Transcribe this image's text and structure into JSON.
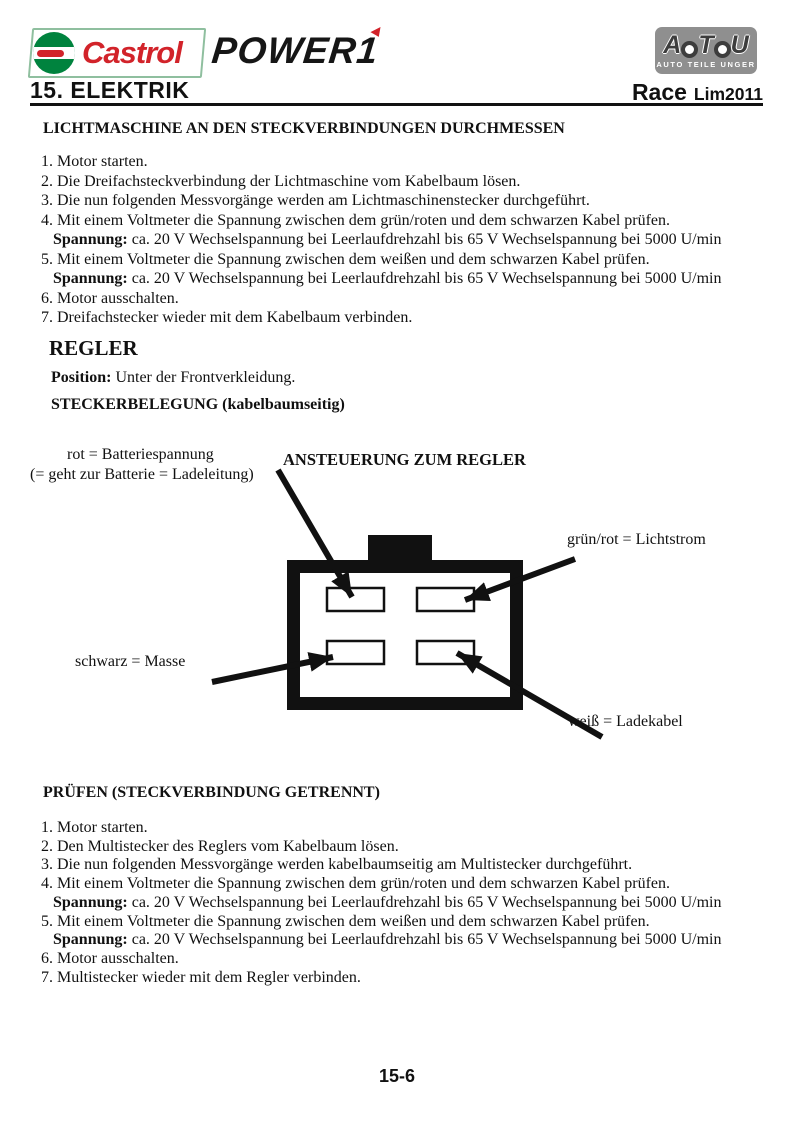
{
  "colors": {
    "castrol_red": "#d2232a",
    "castrol_green": "#00833e",
    "atu_gray": "#8f8f8f",
    "ink": "#111111"
  },
  "header": {
    "castrol_brand": "Castrol",
    "product_logo": "POWER1",
    "atu_letters": [
      "A",
      "T",
      "U"
    ],
    "atu_caption": "AUTO TEILE UNGER",
    "chapter": "15. ELEKTRIK",
    "model": "Race",
    "model_variant": "Lim2011"
  },
  "section1": {
    "title": "LICHTMASCHINE AN DEN STECKVERBINDUNGEN DURCHMESSEN",
    "lines": [
      {
        "text": "1. Motor starten."
      },
      {
        "text": "2. Die Dreifachsteckverbindung der Lichtmaschine vom Kabelbaum lösen."
      },
      {
        "text": "3. Die nun folgenden Messvorgänge werden am Lichtmaschinenstecker durchgeführt."
      },
      {
        "text": "4. Mit einem Voltmeter die Spannung zwischen dem grün/roten und dem schwarzen Kabel prüfen."
      },
      {
        "bold": "Spannung:",
        "text": " ca. 20 V Wechselspannung bei Leerlaufdrehzahl bis 65 V Wechselspannung bei 5000 U/min"
      },
      {
        "text": "5. Mit einem Voltmeter die Spannung zwischen dem weißen und dem schwarzen Kabel prüfen."
      },
      {
        "bold": "Spannung:",
        "text": " ca. 20 V Wechselspannung bei Leerlaufdrehzahl bis 65 V Wechselspannung bei 5000 U/min"
      },
      {
        "text": "6. Motor ausschalten."
      },
      {
        "text": "7. Dreifachstecker wieder mit dem Kabelbaum verbinden."
      }
    ]
  },
  "regler": {
    "title": "REGLER",
    "position_label": "Position:",
    "position_text": "  Unter der Frontverkleidung.",
    "stecker_title": "STECKERBELEGUNG (kabelbaumseitig)"
  },
  "diagram": {
    "heading": "ANSTEUERUNG ZUM REGLER",
    "label_rot_line1": "rot = Batteriespannung",
    "label_rot_line2": "(= geht zur Batterie = Ladeleitung)",
    "label_gruen": "grün/rot = Lichtstrom",
    "label_schwarz": "schwarz = Masse",
    "label_weiss": "weiß = Ladekabel"
  },
  "section2": {
    "title": "PRÜFEN (STECKVERBINDUNG GETRENNT)",
    "lines": [
      {
        "text": "1. Motor starten."
      },
      {
        "text": "2. Den Multistecker des Reglers vom Kabelbaum lösen."
      },
      {
        "text": "3. Die nun folgenden Messvorgänge werden kabelbaumseitig am Multistecker durchgeführt."
      },
      {
        "text": "4. Mit einem Voltmeter die Spannung zwischen dem grün/roten und dem schwarzen Kabel prüfen."
      },
      {
        "bold": "Spannung:",
        "text": " ca. 20 V Wechselspannung bei Leerlaufdrehzahl bis 65 V Wechselspannung bei 5000 U/min"
      },
      {
        "text": "5. Mit einem Voltmeter die Spannung zwischen dem weißen und dem schwarzen Kabel prüfen."
      },
      {
        "bold": "Spannung:",
        "text": " ca. 20 V Wechselspannung bei Leerlaufdrehzahl bis 65 V Wechselspannung bei 5000 U/min"
      },
      {
        "text": "6. Motor ausschalten."
      },
      {
        "text": "7. Multistecker wieder mit dem Regler verbinden."
      }
    ]
  },
  "footer": {
    "page_number": "15-6"
  }
}
